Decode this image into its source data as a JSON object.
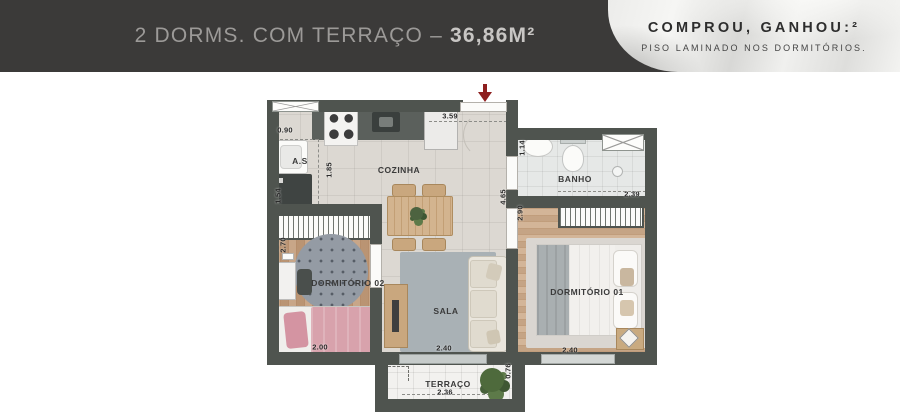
{
  "header": {
    "title_plan": "2 DORMS. COM TERRAÇO – ",
    "title_area": "36,86M²",
    "promo_title": "COMPROU, GANHOU:²",
    "promo_subtitle": "PISO LAMINADO NOS DORMITÓRIOS."
  },
  "rooms": {
    "service_area": "A.S",
    "kitchen": "COZINHA",
    "bathroom": "BANHO",
    "bedroom2": "DORMITÓRIO 02",
    "bedroom1": "DORMITÓRIO 01",
    "living": "SALA",
    "terrace": "TERRAÇO"
  },
  "dimensions": {
    "service_window": "0.90",
    "service_depth": "1.54",
    "kitchen_width": "3.59",
    "kitchen_depth": "1.85",
    "bath_entry": "1.14",
    "bath_width": "2.39",
    "circulation_length": "4.65",
    "bedroom1_depth": "2.90",
    "bedroom2_depth": "2.70",
    "bedroom2_width": "2.00",
    "living_width": "2.40",
    "bedroom1_width": "2.40",
    "terrace_width": "2.36",
    "terrace_depth": "0.76"
  },
  "colors": {
    "header_bg": "#3b3a39",
    "wall": "#4f544f",
    "accent_red": "#8e1f1f",
    "wood_floor": "#c19a78",
    "living_rug": "#a9b1b5",
    "bed_pink": "#d8a2ac"
  }
}
